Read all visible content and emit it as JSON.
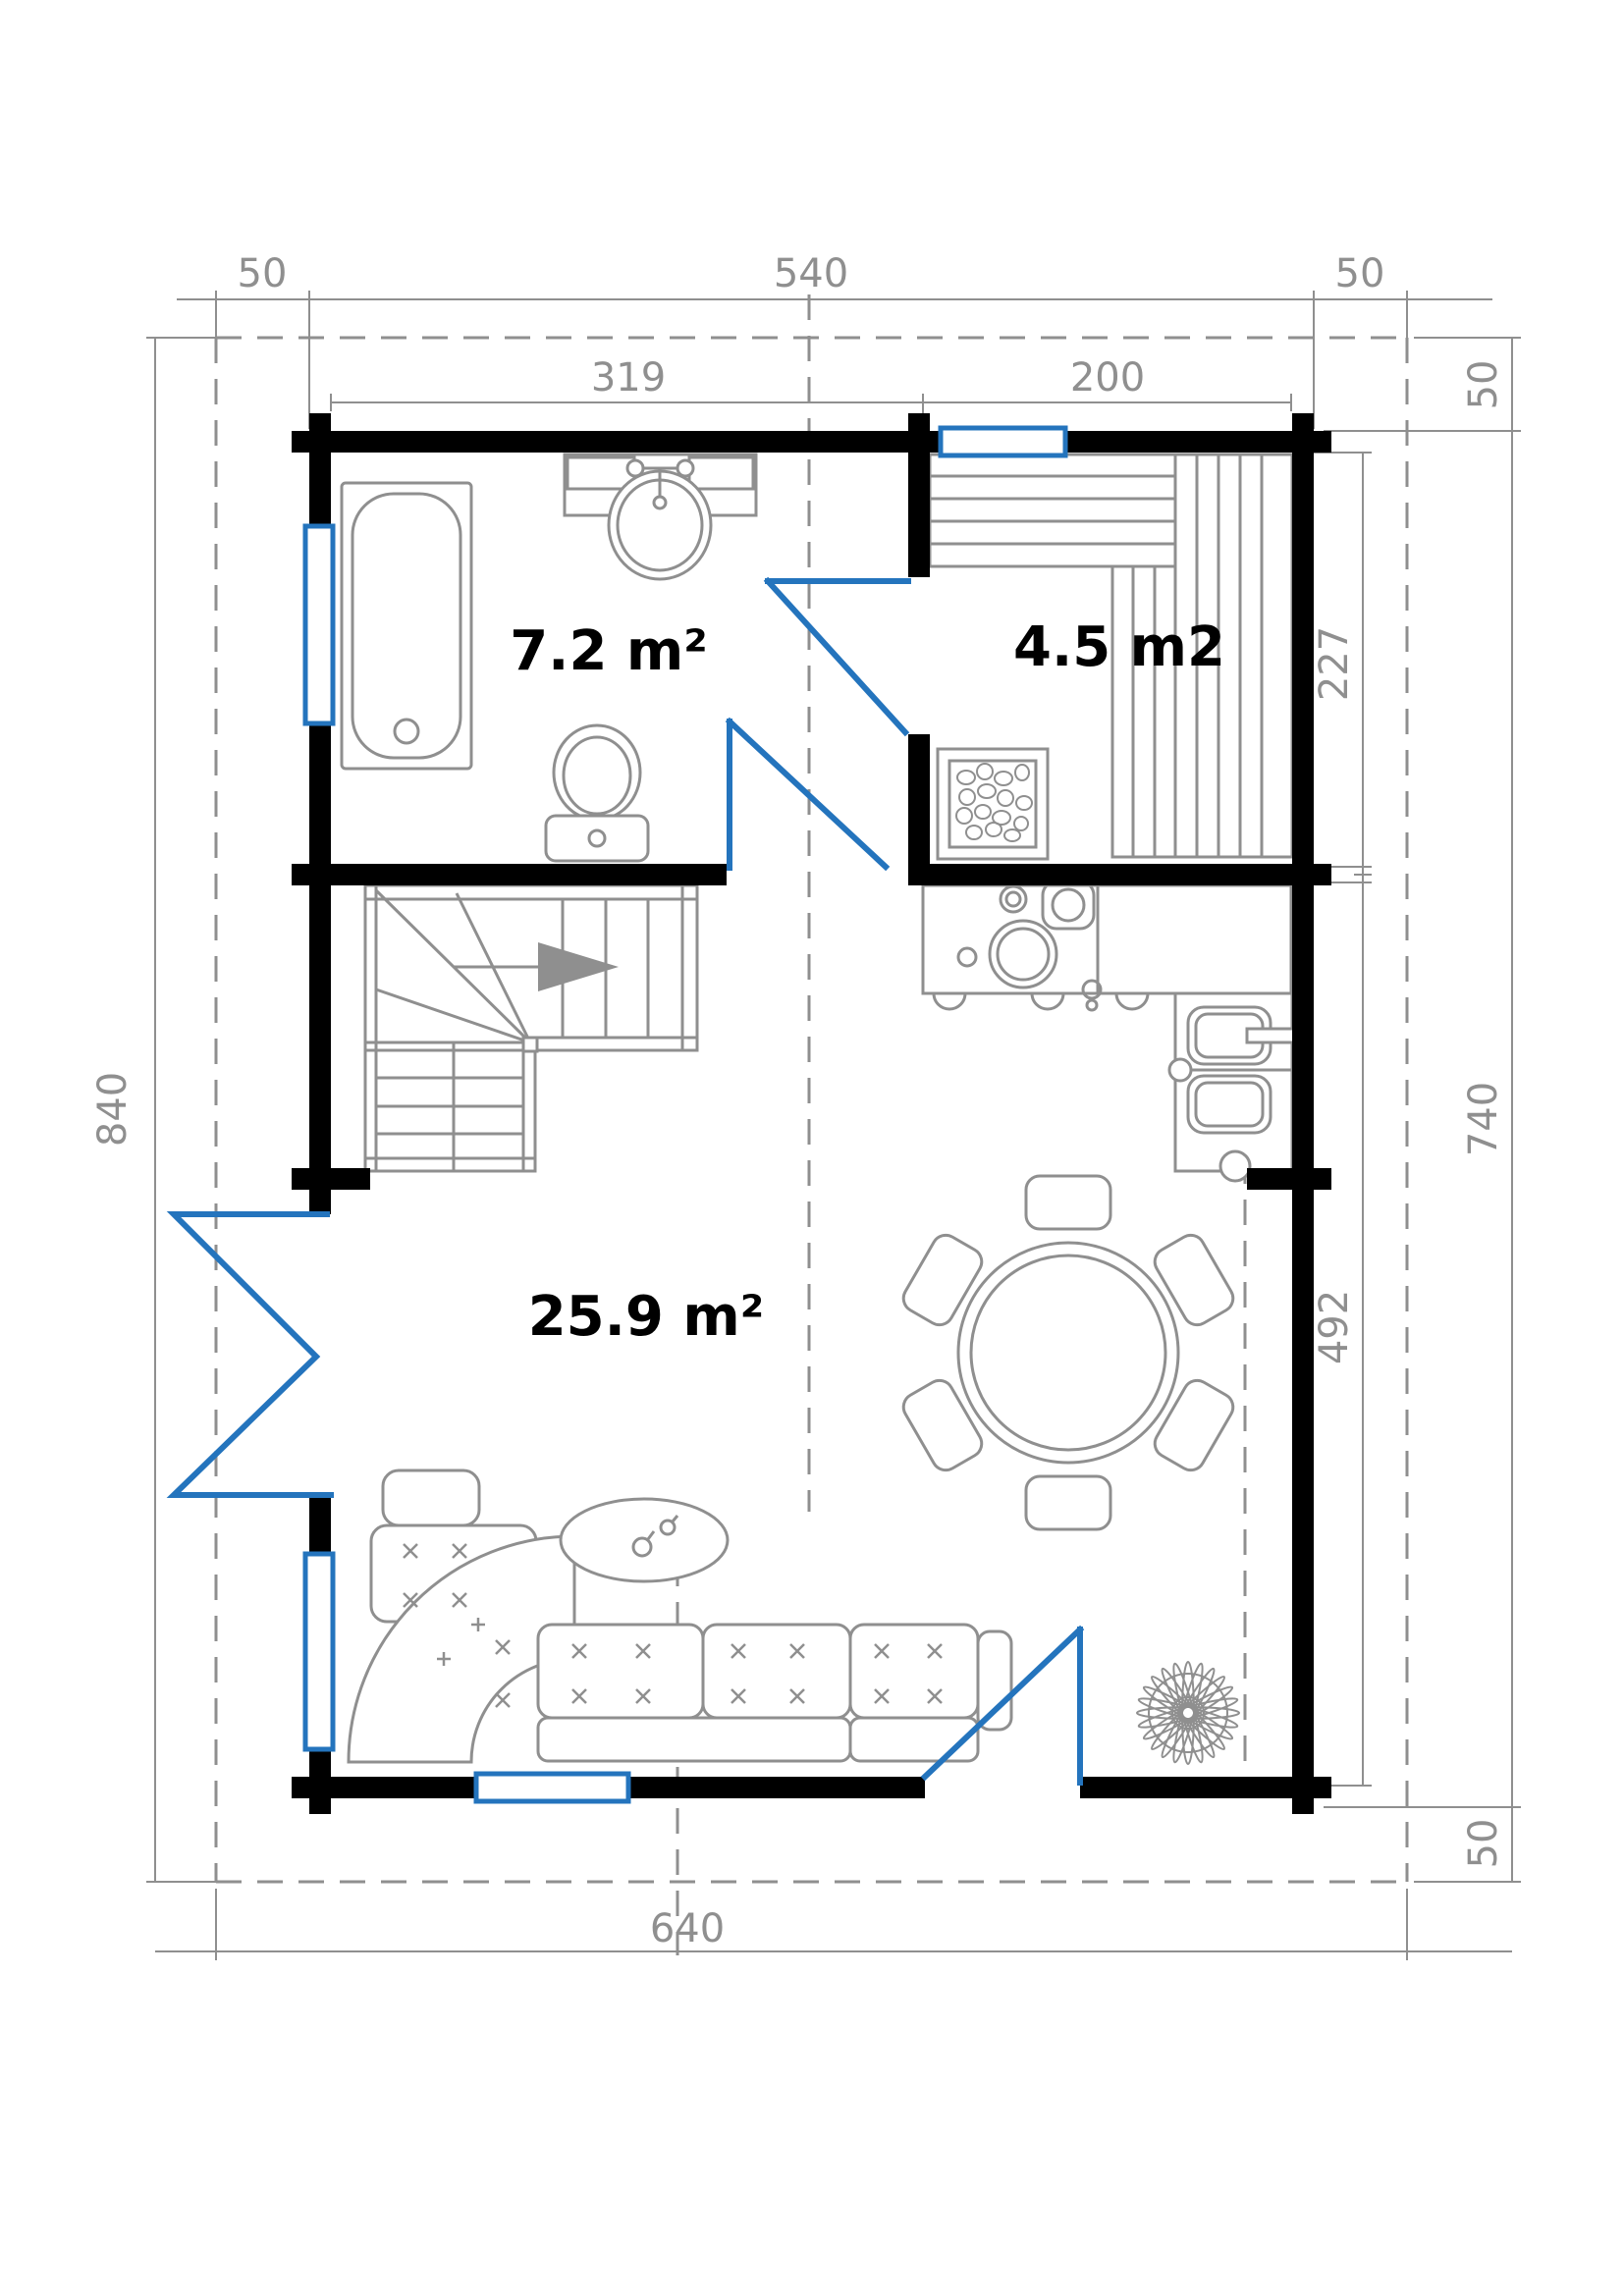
{
  "plan_title": "cabin-ground-floor-plan",
  "colors": {
    "wall": "#000000",
    "fixture_line": "#8f8f8f",
    "accent_blue": "#2474bd",
    "dimension_text": "#8f8f8f",
    "room_label_text": "#000000",
    "background": "#ffffff"
  },
  "dimensions": {
    "top_left_overhang": "50",
    "top_width": "540",
    "top_right_overhang": "50",
    "bathroom_width": "319",
    "sauna_width": "200",
    "right_top_overhang": "50",
    "sauna_depth": "227",
    "right_total_height": "740",
    "living_depth": "492",
    "right_bottom_overhang": "50",
    "left_total_height": "840",
    "bottom_total_width": "640"
  },
  "rooms": {
    "bathroom_area": "7.2 m²",
    "sauna_area": "4.5 m2",
    "living_area": "25.9 m²"
  }
}
